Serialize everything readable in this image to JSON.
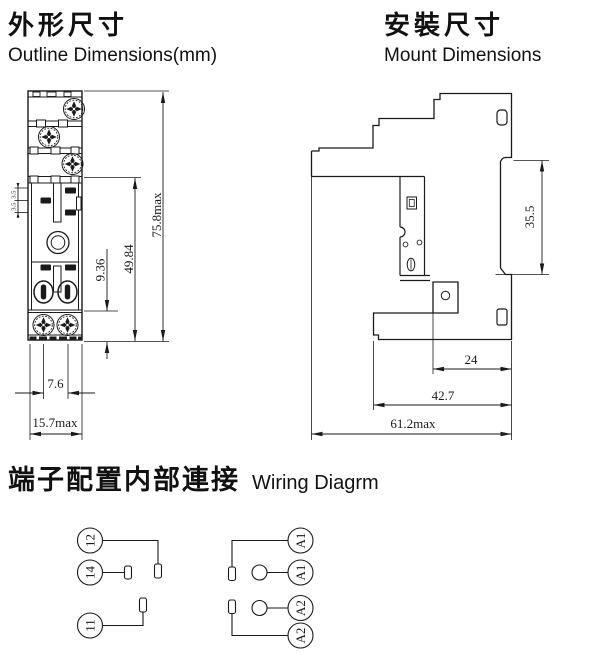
{
  "titles": {
    "outline_zh": "外形尺寸",
    "outline_en": "Outline Dimensions(mm)",
    "mount_zh": "安裝尺寸",
    "mount_en": "Mount Dimensions",
    "wiring_zh": "端子配置内部連接",
    "wiring_en": "Wiring Diagrm"
  },
  "outline_view": {
    "dim_height": "75.8max",
    "dim_body_height": "49.84",
    "dim_base_height": "9.36",
    "dim_slot_top": "3.5",
    "dim_slot_bottom": "3.5",
    "dim_screw_pitch": "7.6",
    "dim_width": "15.7max"
  },
  "mount_view": {
    "dim_rail_height": "35.5",
    "dim_hole_offset": "24",
    "dim_depth": "42.7",
    "dim_width": "61.2max"
  },
  "wiring": {
    "left_terminals": [
      "12",
      "14",
      "11"
    ],
    "right_terminals": [
      "A1",
      "A1",
      "A2",
      "A2"
    ]
  },
  "colors": {
    "ink": "#1a1a1a",
    "bg": "#ffffff"
  }
}
